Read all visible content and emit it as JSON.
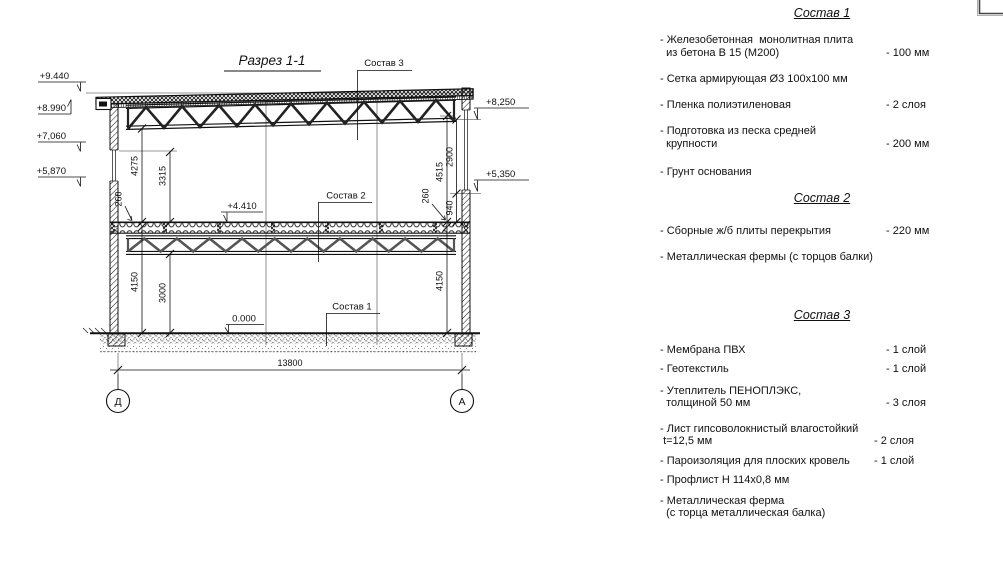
{
  "drawing": {
    "title": "Разрез 1-1",
    "callouts": {
      "c1": "Состав 1",
      "c2": "Состав 2",
      "c3": "Состав 3"
    },
    "elevations": {
      "left": [
        "+9.440",
        "+8.990",
        "+7,060",
        "+5,870"
      ],
      "right": [
        "+8,250",
        "+5,350"
      ],
      "floor": "+4.410",
      "ground": "0.000"
    },
    "dims": {
      "span": "13800",
      "left": [
        "4275",
        "3315",
        "260",
        "4150",
        "3000"
      ],
      "right": [
        "4515",
        "2900",
        "260",
        "940",
        "4150"
      ]
    },
    "axes": {
      "left": "Д",
      "right": "А"
    }
  },
  "panel": {
    "sections": [
      {
        "title": "Состав 1",
        "items": [
          {
            "name": "- Железобетонная  монолитная плита\n  из бетона В 15 (М200)",
            "value": "- 100 мм"
          },
          {
            "name": "- Сетка армирующая Ø3 100х100 мм",
            "value": ""
          },
          {
            "name": "- Пленка полиэтиленовая",
            "value": "- 2 слоя"
          },
          {
            "name": "- Подготовка из песка средней\n  крупности",
            "value": "- 200 мм"
          },
          {
            "name": "- Грунт основания",
            "value": ""
          }
        ]
      },
      {
        "title": "Состав 2",
        "items": [
          {
            "name": "- Сборные ж/б плиты перекрытия",
            "value": "- 220 мм"
          },
          {
            "name": "- Металлическая фермы (с торцов балки)",
            "value": ""
          }
        ]
      },
      {
        "title": "Состав 3",
        "items": [
          {
            "name": "- Мембрана ПВХ",
            "value": "- 1 слой"
          },
          {
            "name": "- Геотекстиль",
            "value": "- 1 слой"
          },
          {
            "name": "- Утеплитель ПЕНОПЛЭКС,\n  толщиной 50 мм",
            "value": "- 3 слоя"
          },
          {
            "name": "- Лист гипсоволокнистый влагостойкий\n t=12,5 мм",
            "value": "- 2 слоя"
          },
          {
            "name": "- Пароизоляция для плоских кровель",
            "value": "- 1 слой"
          },
          {
            "name": "- Профлист Н 114х0,8 мм",
            "value": ""
          },
          {
            "name": "- Металлическая ферма\n  (с торца металлическая балка)",
            "value": ""
          }
        ]
      }
    ]
  }
}
